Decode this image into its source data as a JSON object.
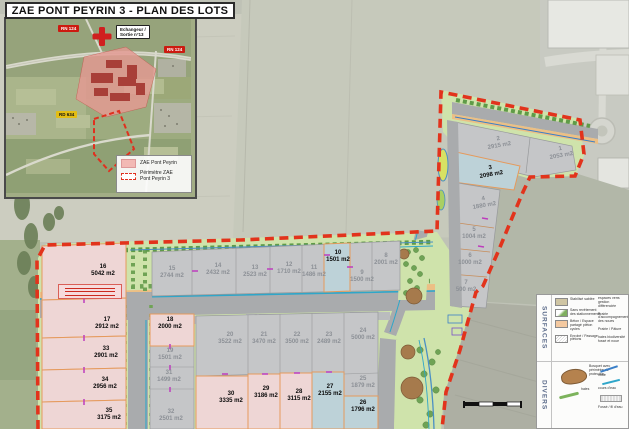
{
  "title": "ZAE PONT PEYRIN 3 - PLAN DES LOTS",
  "inset": {
    "rn124_top": "RN 124",
    "rn124_right": "RN 124",
    "rd634": "RD 634",
    "echangeur_line1": "Echangeur /",
    "echangeur_line2": "Sortie n°13",
    "legend": {
      "zae": "ZAE Pont Peyrin",
      "perimetre_line1": "Périmètre ZAE",
      "perimetre_line2": "Pont Peyrin 3"
    }
  },
  "lots": [
    {
      "n": "1",
      "a": "2053 m2",
      "t": "gray"
    },
    {
      "n": "2",
      "a": "2915 m2",
      "t": "gray"
    },
    {
      "n": "3",
      "a": "2098 m2",
      "t": "blue"
    },
    {
      "n": "4",
      "a": "1880 m2",
      "t": "gray"
    },
    {
      "n": "5",
      "a": "1004 m2",
      "t": "gray"
    },
    {
      "n": "6",
      "a": "1000 m2",
      "t": "gray"
    },
    {
      "n": "7",
      "a": "500 m2",
      "t": "gray"
    },
    {
      "n": "8",
      "a": "2001 m2",
      "t": "gray"
    },
    {
      "n": "9",
      "a": "1500 m2",
      "t": "gray"
    },
    {
      "n": "10",
      "a": "1501 m2",
      "t": "blue"
    },
    {
      "n": "11",
      "a": "1486 m2",
      "t": "gray"
    },
    {
      "n": "12",
      "a": "1710 m2",
      "t": "gray"
    },
    {
      "n": "13",
      "a": "2523 m2",
      "t": "gray"
    },
    {
      "n": "14",
      "a": "2432 m2",
      "t": "gray"
    },
    {
      "n": "15",
      "a": "2744 m2",
      "t": "gray"
    },
    {
      "n": "16",
      "a": "5042 m2",
      "t": "pink"
    },
    {
      "n": "17",
      "a": "2912 m2",
      "t": "pink"
    },
    {
      "n": "18",
      "a": "2000 m2",
      "t": "pink"
    },
    {
      "n": "19",
      "a": "1501 m2",
      "t": "gray"
    },
    {
      "n": "20",
      "a": "3522 m2",
      "t": "gray"
    },
    {
      "n": "21",
      "a": "3470 m2",
      "t": "gray"
    },
    {
      "n": "22",
      "a": "3500 m2",
      "t": "gray"
    },
    {
      "n": "23",
      "a": "2489 m2",
      "t": "gray"
    },
    {
      "n": "24",
      "a": "5000 m2",
      "t": "gray"
    },
    {
      "n": "25",
      "a": "1879 m2",
      "t": "gray"
    },
    {
      "n": "26",
      "a": "1796 m2",
      "t": "blue"
    },
    {
      "n": "27",
      "a": "2155 m2",
      "t": "blue"
    },
    {
      "n": "28",
      "a": "3115 m2",
      "t": "pink"
    },
    {
      "n": "29",
      "a": "3186 m2",
      "t": "pink"
    },
    {
      "n": "30",
      "a": "3335 m2",
      "t": "pink"
    },
    {
      "n": "31",
      "a": "1499 m2",
      "t": "gray"
    },
    {
      "n": "32",
      "a": "2501 m2",
      "t": "gray"
    },
    {
      "n": "33",
      "a": "2901 m2",
      "t": "pink"
    },
    {
      "n": "34",
      "a": "2956 m2",
      "t": "pink"
    },
    {
      "n": "35",
      "a": "3175 m2",
      "t": "pink"
    }
  ],
  "side_legend": {
    "surfaces_title": "SURFACES",
    "divers_title": "DIVERS",
    "surfaces_items": [
      "Stabilisé sablée",
      "Sans revêtement des stationnements",
      "Béton / Espace partagé piéton cycles",
      "Enrobé / Passage piétons"
    ],
    "surfaces_items_right": [
      "espaces verts gestion différenciée",
      "Prairie d'accompagnement des noues",
      "Prairie / Pâture",
      "haies biodiversité fossé et noue"
    ],
    "divers_items": [
      "Bosquet avec périmètre de protection",
      "haies"
    ],
    "divers_items_right": [
      "noue",
      "cours d'eau",
      "Fossé / fil d'eau"
    ]
  },
  "colors": {
    "boundary_red": "#e2331c",
    "lot_pink": "#eed6d5",
    "lot_blue": "#bdd2d8",
    "lot_gray": "#c5c6c8",
    "green": "#cfe3ab",
    "road": "#a9abad",
    "lot_border_orange": "#e59a5d"
  }
}
